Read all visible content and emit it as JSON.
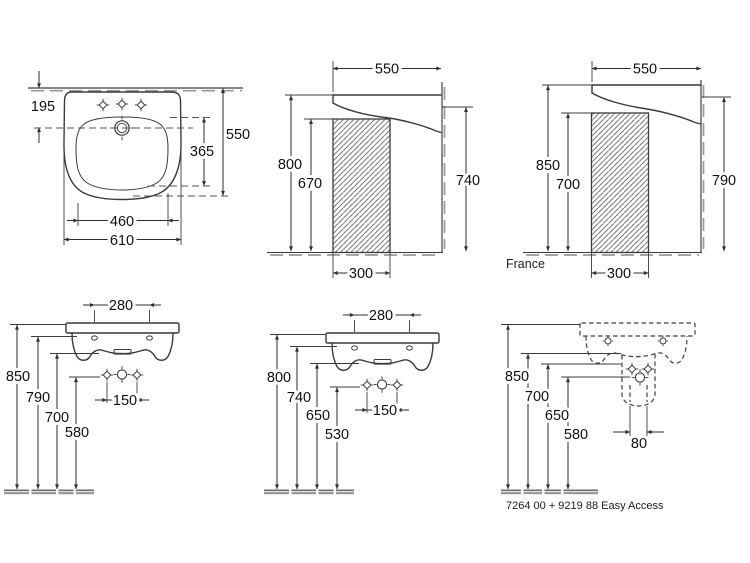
{
  "colors": {
    "line": "#3a3a3a",
    "dimension": "#2e2e2e",
    "wall_tick": "#9a9a9a",
    "background": "#ffffff"
  },
  "views": {
    "top": {
      "dims": {
        "tap_to_wall": "195",
        "depth": "550",
        "bowl_depth": "365",
        "bowl_width": "460",
        "width": "610"
      }
    },
    "side": {
      "dims": {
        "depth": "550",
        "rim_height": "800",
        "clearance_height": "670",
        "fixing_height": "740",
        "recess_width": "300"
      }
    },
    "side_france": {
      "label": "France",
      "dims": {
        "depth": "550",
        "rim_height": "850",
        "clearance_height": "700",
        "fixing_height": "790",
        "recess_width": "300"
      }
    },
    "front": {
      "dims": {
        "fixing_centers": "280",
        "rim_height": "850",
        "fixing_height": "790",
        "underside_height": "700",
        "tap_height": "580",
        "tap_centers": "150"
      }
    },
    "front_alt": {
      "dims": {
        "fixing_centers": "280",
        "rim_height": "800",
        "fixing_height": "740",
        "underside_height": "650",
        "tap_height": "530",
        "tap_centers": "150"
      }
    },
    "front_easy": {
      "label": "7264 00 + 9219 88 Easy Access",
      "dims": {
        "rim_height": "850",
        "underside_height": "700",
        "siphon_height": "650",
        "tap_height": "580",
        "drain_centers": "80"
      }
    }
  }
}
